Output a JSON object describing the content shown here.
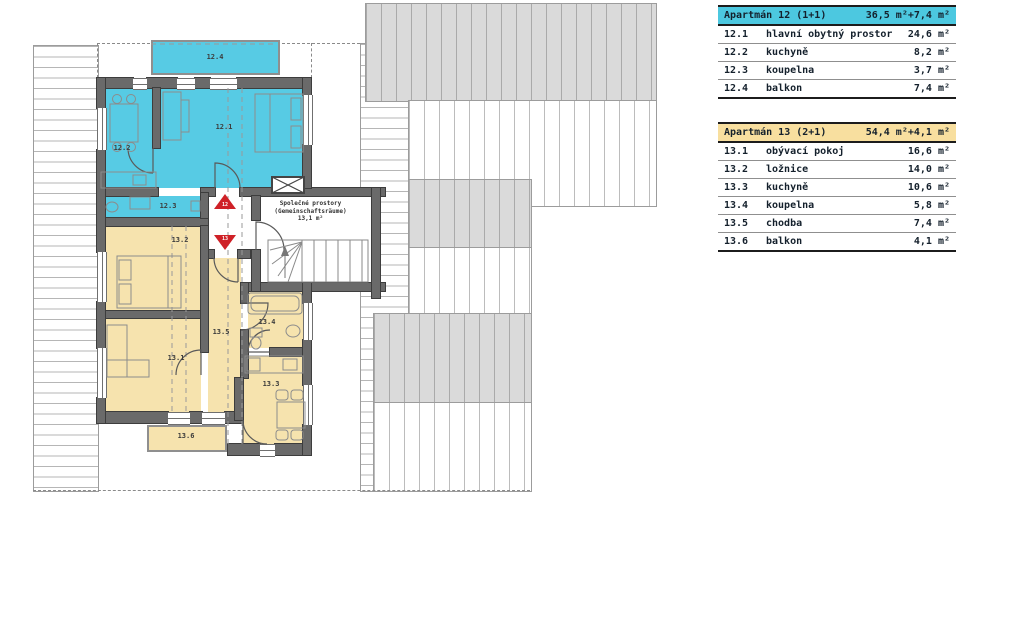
{
  "plan": {
    "room_labels": {
      "r12_1": "12.1",
      "r12_2": "12.2",
      "r12_3": "12.3",
      "r12_4": "12.4",
      "r13_1": "13.1",
      "r13_2": "13.2",
      "r13_3": "13.3",
      "r13_4": "13.4",
      "r13_5": "13.5",
      "r13_6": "13.6"
    },
    "common_room": {
      "line1": "Společné prostory",
      "line2": "(Gemeinschaftsräume)",
      "area": "13,1 m²"
    },
    "entrance_markers": {
      "apt12": "12",
      "apt13": "13"
    }
  },
  "legend_tables": [
    {
      "title": "Apartmán 12 (1+1)",
      "total_area": "36,5 m²+7,4 m²",
      "rows": [
        {
          "num": "12.1",
          "name": "hlavní obytný prostor",
          "area": "24,6 m²"
        },
        {
          "num": "12.2",
          "name": "kuchyně",
          "area": "8,2 m²"
        },
        {
          "num": "12.3",
          "name": "koupelna",
          "area": "3,7 m²"
        },
        {
          "num": "12.4",
          "name": "balkon",
          "area": "7,4 m²"
        }
      ]
    },
    {
      "title": "Apartmán 13 (2+1)",
      "total_area": "54,4 m²+4,1 m²",
      "rows": [
        {
          "num": "13.1",
          "name": "obývací pokoj",
          "area": "16,6 m²"
        },
        {
          "num": "13.2",
          "name": "ložnice",
          "area": "14,0 m²"
        },
        {
          "num": "13.3",
          "name": "kuchyně",
          "area": "10,6 m²"
        },
        {
          "num": "13.4",
          "name": "koupelna",
          "area": "5,8 m²"
        },
        {
          "num": "13.5",
          "name": "chodba",
          "area": "7,4 m²"
        },
        {
          "num": "13.6",
          "name": "balkon",
          "area": "4,1 m²"
        }
      ]
    }
  ],
  "colors": {
    "apartment12_fill": "#57cbe4",
    "apartment13_fill": "#f6e3ae",
    "header12": "#4cc8e0",
    "header13": "#f8df9f",
    "wall": "#6a6a6a",
    "roof_gray": "#dadada",
    "entrance_marker_red": "#cf2127"
  }
}
